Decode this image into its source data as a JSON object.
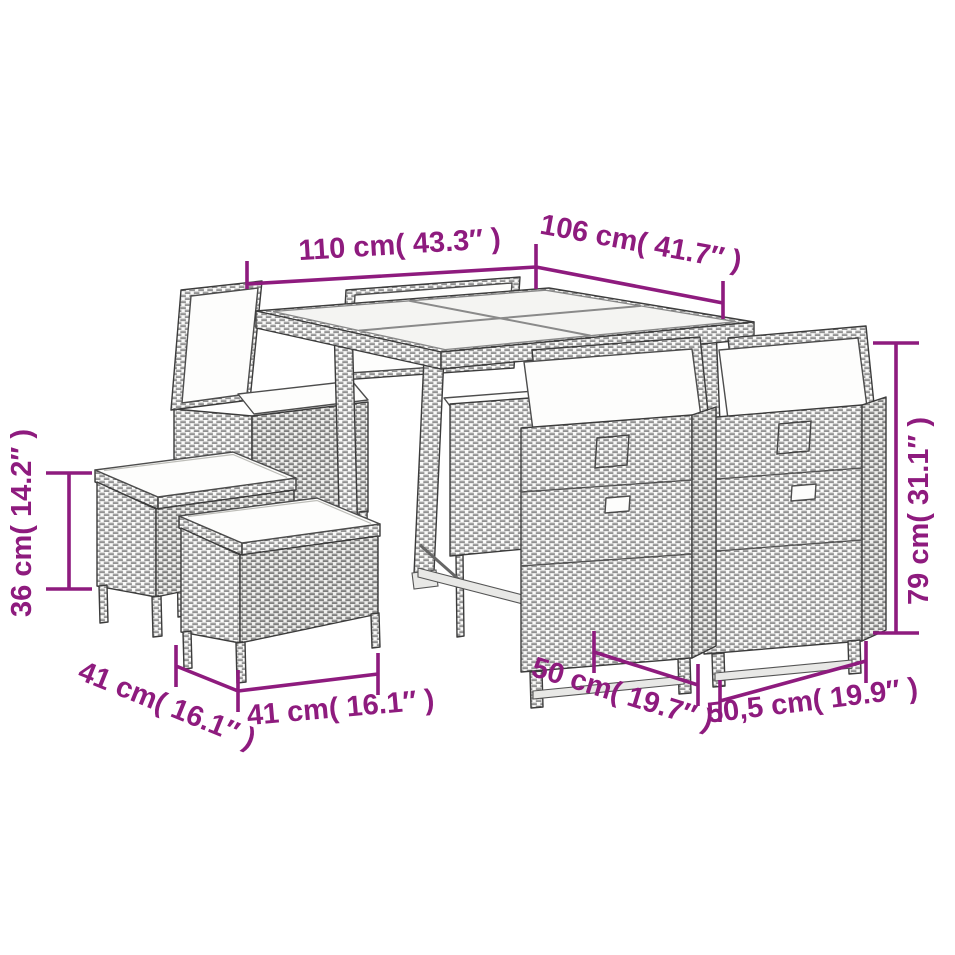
{
  "accent_color": "#8e1b7e",
  "illustration": {
    "subject": "rattan cube dining set line drawing",
    "pieces": {
      "table": "table",
      "chair": "chair",
      "stool": "stool"
    }
  },
  "dimensions": {
    "table_width": "110 cm( 43.3″ )",
    "table_depth": "106 cm( 41.7″ )",
    "stool_height": "36 cm( 14.2″ )",
    "chair_height": "79 cm( 31.1″ )",
    "stool_depth": "41 cm( 16.1″ )",
    "stool_width": "41 cm( 16.1″ )",
    "chair_width": "50 cm( 19.7″ )",
    "chair_depth": "50,5 cm( 19.9″ )"
  }
}
